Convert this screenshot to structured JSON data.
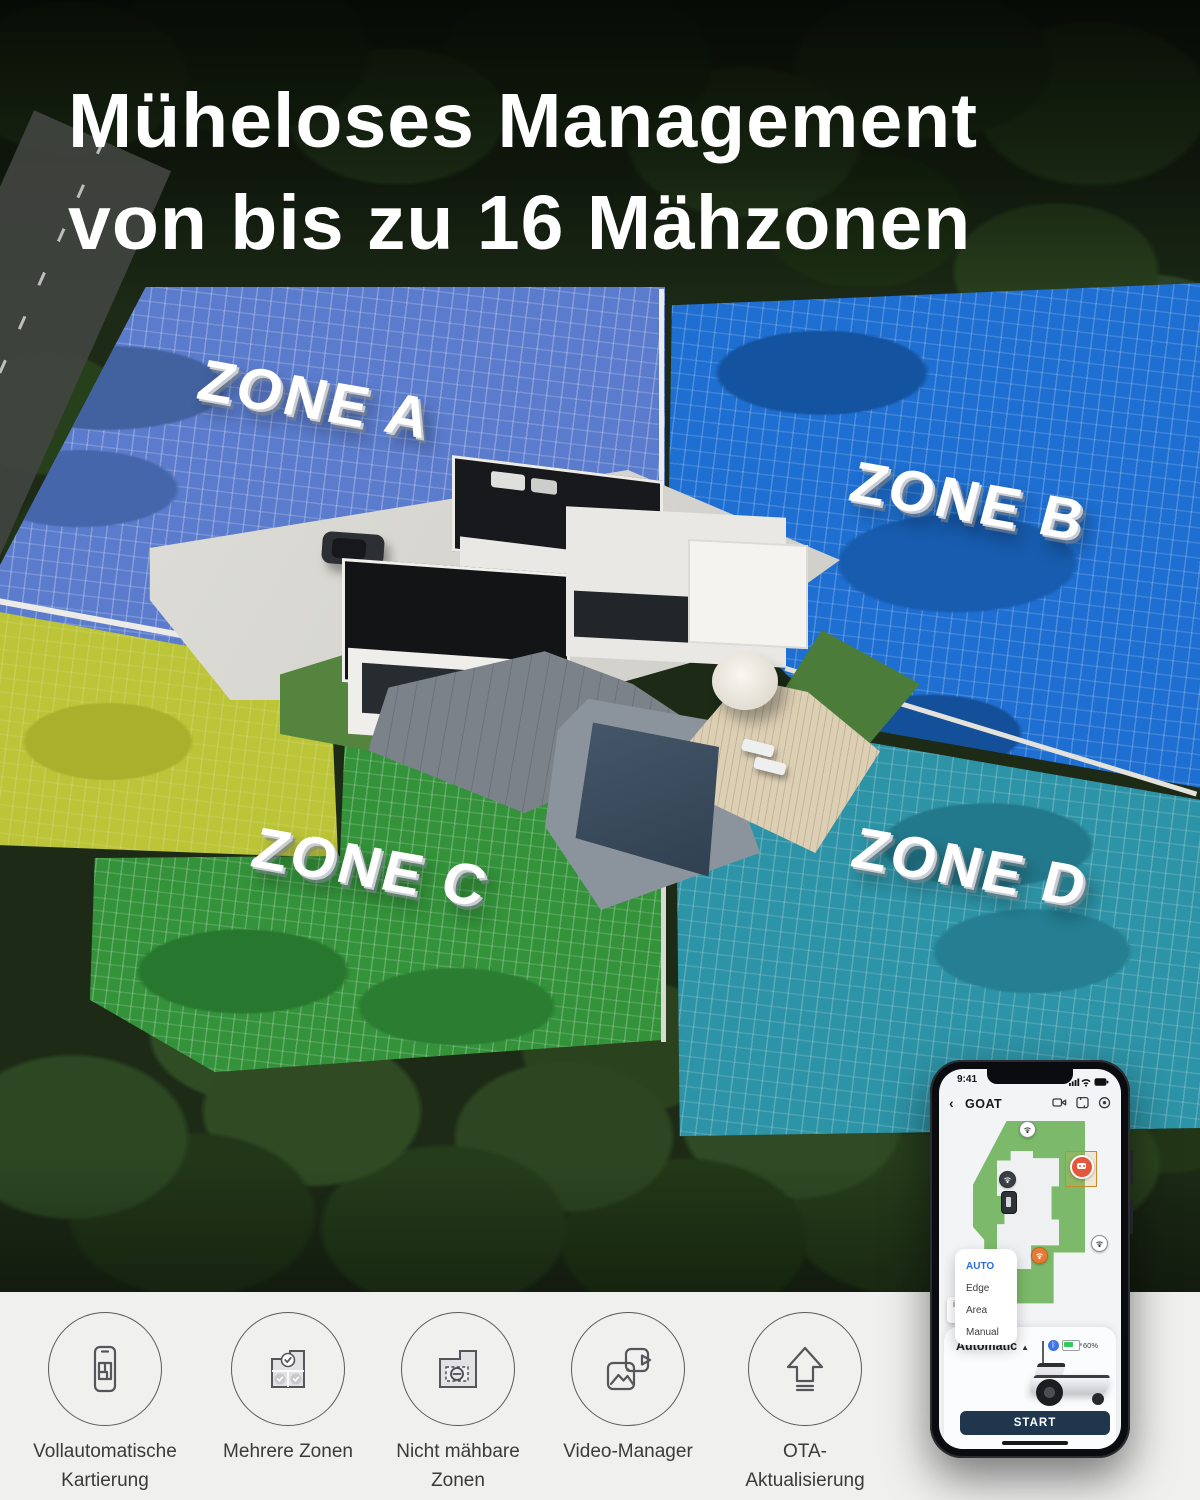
{
  "title": {
    "line1": "Müheloses Management",
    "line2": "von bis zu 16 Mähzonen"
  },
  "zones": {
    "a": "ZONE A",
    "b": "ZONE B",
    "c": "ZONE C",
    "d": "ZONE D"
  },
  "phone": {
    "status_time": "9:41",
    "back_chevron": "‹",
    "app_title": "GOAT",
    "dropdown_options": [
      {
        "label": "AUTO"
      },
      {
        "label": "Edge"
      },
      {
        "label": "Area"
      },
      {
        "label": "Manual"
      }
    ],
    "mode_label": "Automatic",
    "mode_caret": "▲",
    "battery_percent": "60%",
    "bluetooth_glyph": "ᛒ",
    "info_glyph": "i",
    "start_label": "START"
  },
  "features": [
    {
      "icon": "phone-map-icon",
      "line1": "Vollautomatische",
      "line2": "Kartierung"
    },
    {
      "icon": "multi-zone-icon",
      "line1": "Mehrere Zonen",
      "line2": ""
    },
    {
      "icon": "no-mow-zone-icon",
      "line1": "Nicht mähbare",
      "line2": "Zonen"
    },
    {
      "icon": "video-manager-icon",
      "line1": "Video-Manager",
      "line2": ""
    },
    {
      "icon": "ota-update-icon",
      "line1": "OTA-",
      "line2": "Aktualisierung"
    }
  ],
  "colors": {
    "zone_a": "#5b7ccd",
    "zone_b": "#1e6fd1",
    "zone_c": "#33923a",
    "zone_d": "#2d93a6",
    "side_zone_yellow": "#bcc437",
    "app_accent_blue": "#2e6be6",
    "start_button": "#20364d",
    "robot_marker_orange": "#e4573d",
    "map_lawn_green": "#7cb96a"
  }
}
